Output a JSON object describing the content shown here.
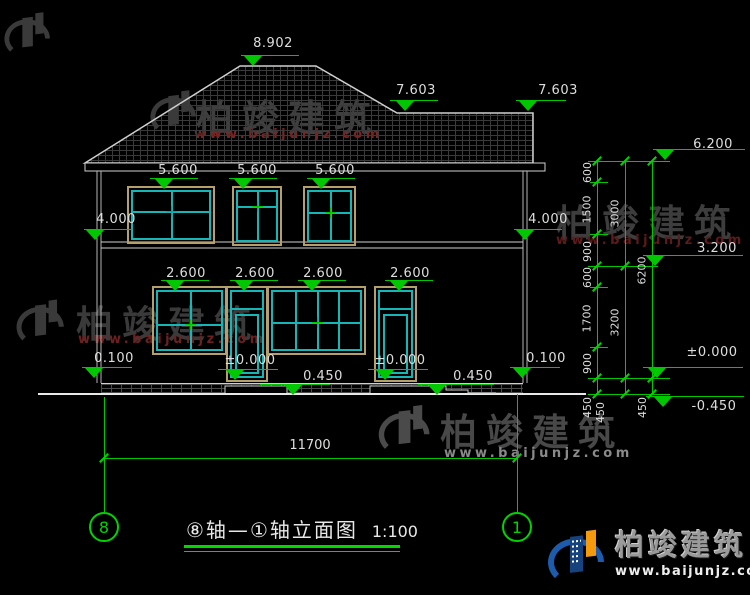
{
  "watermark": {
    "brand": "柏竣建筑",
    "url": "www.baijunjz.com"
  },
  "title": {
    "part1": "⑧轴—",
    "part2": "①轴立面图",
    "scale": "1:100"
  },
  "axis_bubbles": {
    "left": "8",
    "right": "1"
  },
  "levels": {
    "ridge": "8.902",
    "roof_break": [
      "7.603",
      "7.603"
    ],
    "eave": "6.200",
    "floor2_top": "3.200",
    "zero": "±0.000",
    "ground": "-0.450",
    "floor2": [
      "4.000",
      "4.000"
    ],
    "win2_head": [
      "5.600",
      "5.600",
      "5.600"
    ],
    "win1_head": [
      "2.600",
      "2.600",
      "2.600",
      "2.600"
    ],
    "plinth": [
      "0.100",
      "0.100"
    ],
    "door_zero": [
      "±0.000",
      "±0.000"
    ],
    "step": [
      "0.450",
      "0.450"
    ]
  },
  "dims": {
    "col_inner": [
      "600",
      "1500",
      "900",
      "600",
      "1700",
      "900"
    ],
    "col_mid": [
      "3000",
      "3200"
    ],
    "col_outer": [
      "6200"
    ],
    "bottom_450": [
      "450",
      "450",
      "450"
    ],
    "total_width": "11700"
  }
}
